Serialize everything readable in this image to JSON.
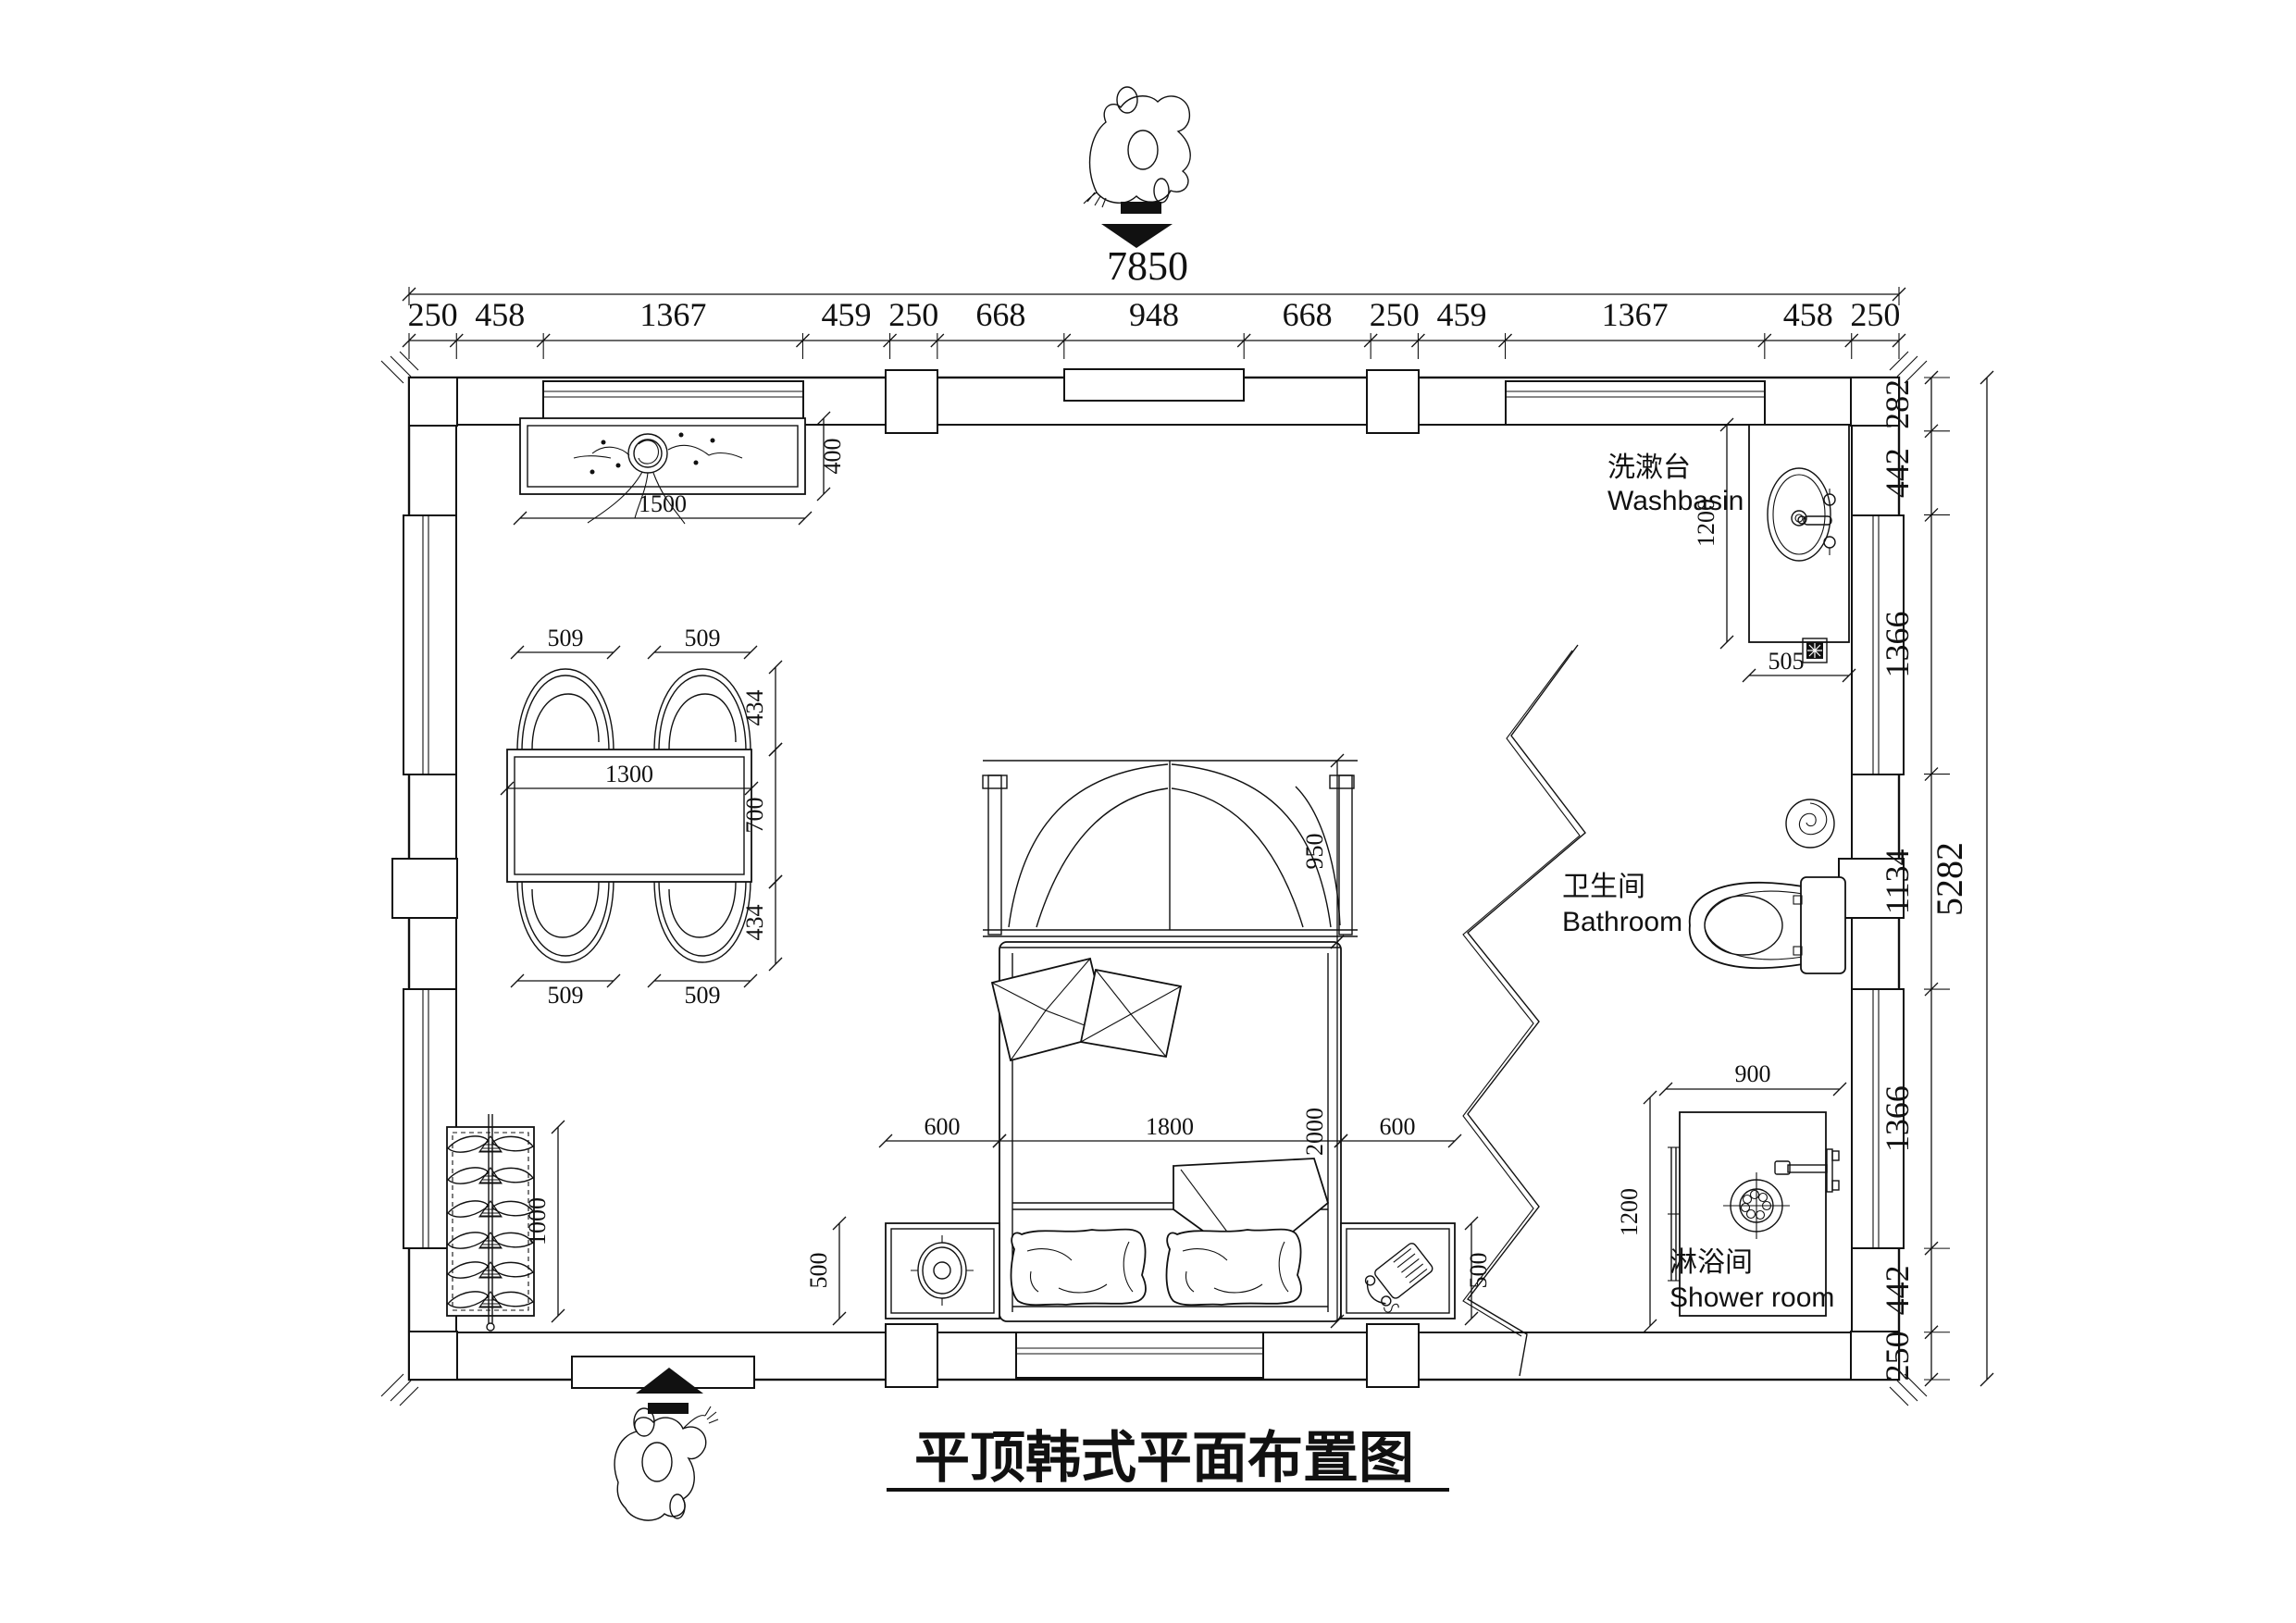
{
  "title": "平顶韩式平面布置图",
  "floorplan": {
    "rooms": {
      "washbasin": {
        "label_cn": "洗漱台",
        "label_en": "Washbasin"
      },
      "bathroom": {
        "label_cn": "卫生间",
        "label_en": "Bathroom"
      },
      "shower": {
        "label_cn": "淋浴间",
        "label_en": "Shower room"
      }
    },
    "dimensions": {
      "top_total": "7850",
      "top_chain": [
        "250",
        "458",
        "1367",
        "459",
        "250",
        "668",
        "948",
        "668",
        "250",
        "459",
        "1367",
        "458",
        "250"
      ],
      "right_total": "5282",
      "right_chain": [
        "282",
        "442",
        "1366",
        "1134",
        "1366",
        "442",
        "250"
      ],
      "console": {
        "width": "1500",
        "depth": "400"
      },
      "dining": {
        "table_width": "1300",
        "table_depth": "700",
        "chair_width": "509",
        "chair_depth": "434"
      },
      "wardrobe": {
        "width": "1000"
      },
      "bed": {
        "side_left": "600",
        "width": "1800",
        "side_right": "600",
        "headboard": "950",
        "length": "2000",
        "nightstand_depth": "500"
      },
      "washbasin": {
        "length": "1200",
        "depth": "505"
      },
      "shower": {
        "width": "900",
        "depth": "1200"
      }
    }
  }
}
